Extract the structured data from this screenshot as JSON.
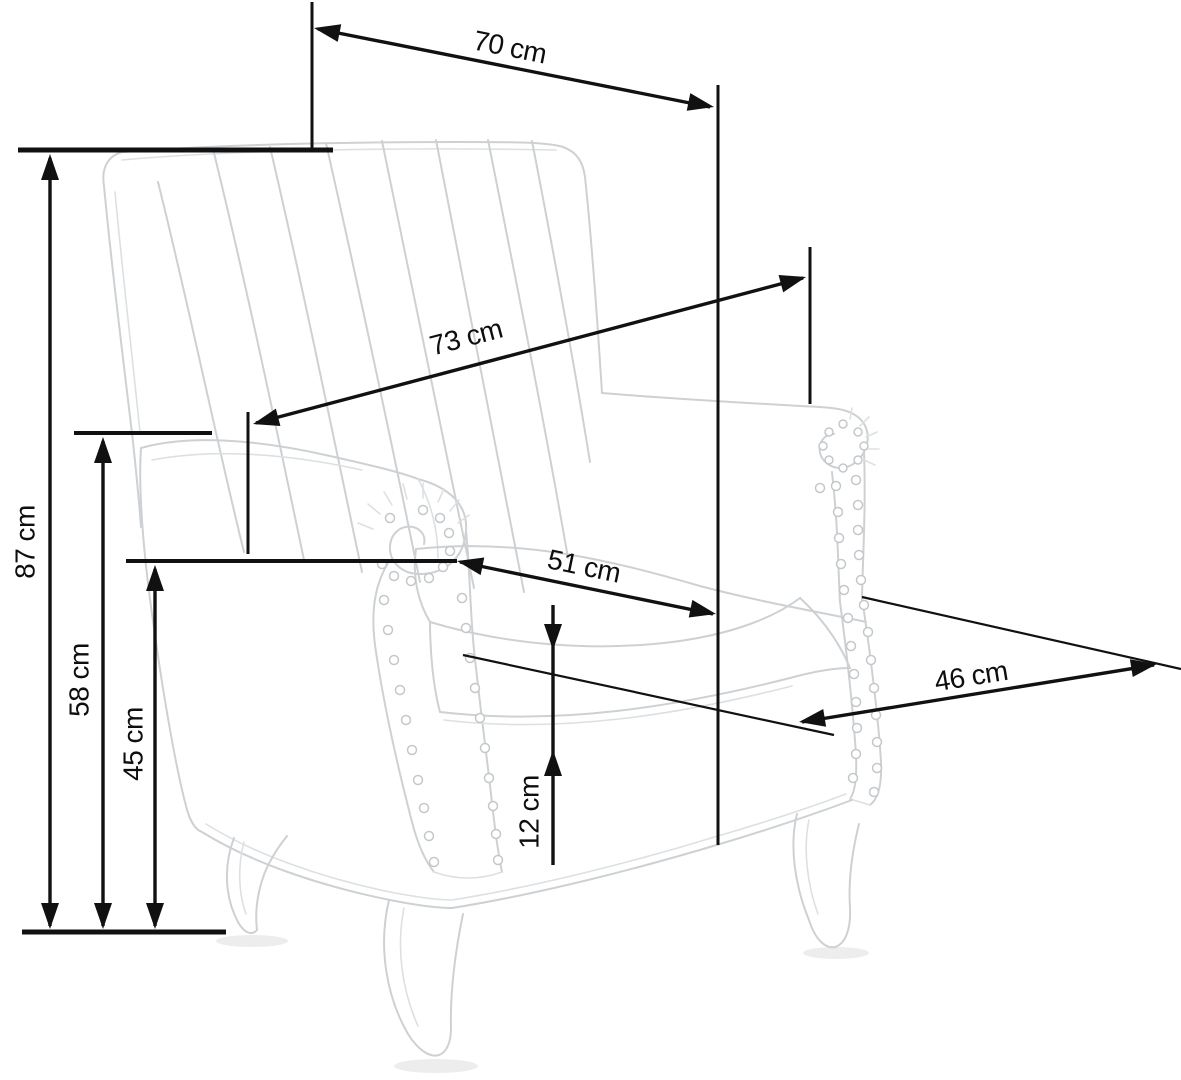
{
  "diagram": {
    "kind": "furniture-dimension-diagram",
    "subject": "wingback-armchair-sketch",
    "unit": "cm",
    "colors": {
      "background": "#ffffff",
      "dimension_lines": "#111111",
      "sketch_lines": "#cdd1d4"
    }
  },
  "dimensions": [
    {
      "id": "overall-width-top",
      "label": "70 cm",
      "value": 70,
      "unit": "cm"
    },
    {
      "id": "backrest-diagonal",
      "label": "73 cm",
      "value": 73,
      "unit": "cm"
    },
    {
      "id": "overall-height",
      "label": "87 cm",
      "value": 87,
      "unit": "cm"
    },
    {
      "id": "armrest-height",
      "label": "58 cm",
      "value": 58,
      "unit": "cm"
    },
    {
      "id": "seat-height",
      "label": "45 cm",
      "value": 45,
      "unit": "cm"
    },
    {
      "id": "seat-width",
      "label": "51 cm",
      "value": 51,
      "unit": "cm"
    },
    {
      "id": "seat-depth",
      "label": "46 cm",
      "value": 46,
      "unit": "cm"
    },
    {
      "id": "cushion-thickness",
      "label": "12 cm",
      "value": 12,
      "unit": "cm"
    }
  ]
}
